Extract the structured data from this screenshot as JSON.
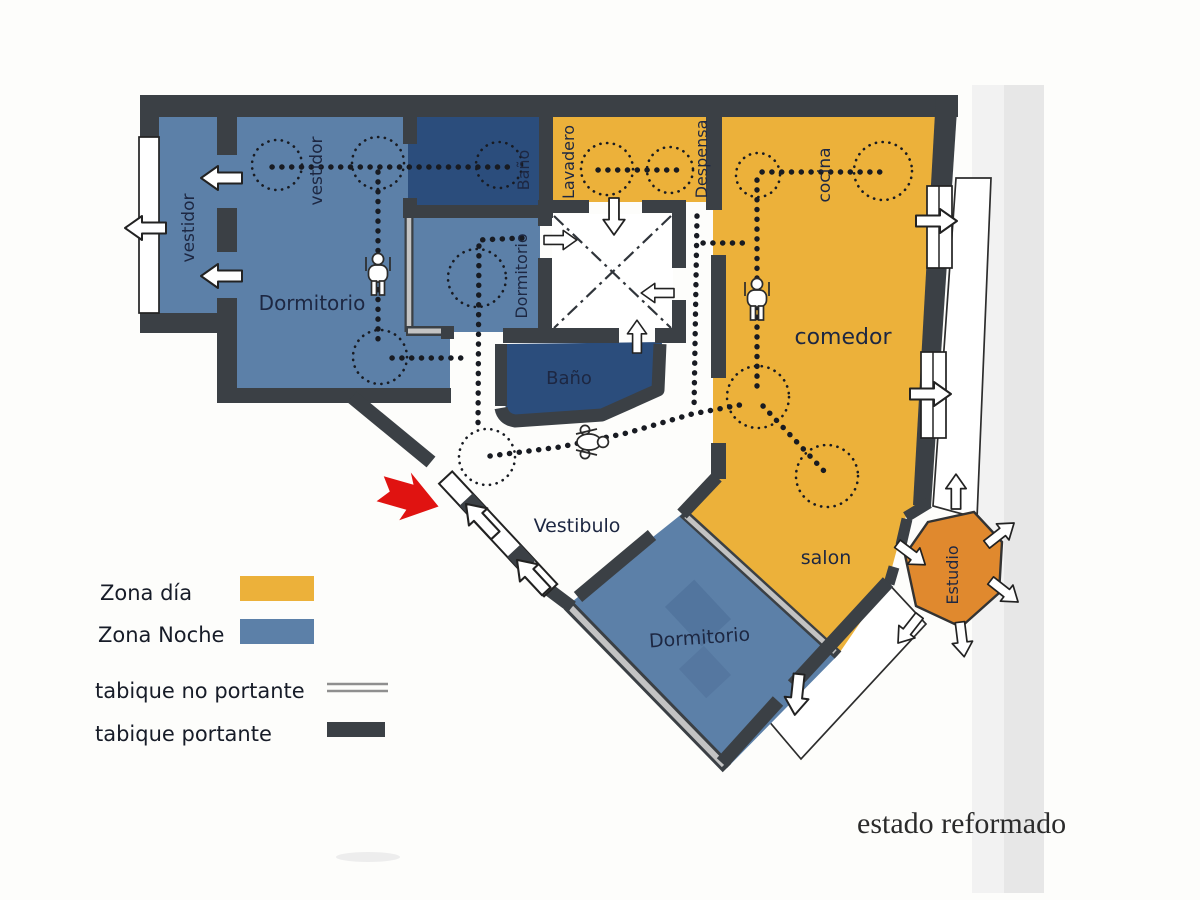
{
  "title": "estado reformado",
  "colors": {
    "day": "#ecb13a",
    "night": "#5c80a8",
    "bath": "#2b4d7c",
    "studio": "#e0892e",
    "wall": "#3b4045",
    "partition_gray": "#c3c3c3",
    "entrance_red": "#e01311",
    "label_ink": "#1d2742"
  },
  "icons": {
    "door_arrow": "white-block-arrow",
    "person": "person-figure",
    "wheelchair": "wheelchair-person-figure",
    "entrance": "red-entrance-arrow",
    "patio": "crossed-lightwell"
  },
  "rooms": [
    {
      "label": "vestidor",
      "zone": "night"
    },
    {
      "label": "vestidor",
      "zone": "night"
    },
    {
      "label": "Dormitorio",
      "zone": "night"
    },
    {
      "label": "Baño",
      "zone": "bath"
    },
    {
      "label": "Dormitorio",
      "zone": "night"
    },
    {
      "label": "Lavadero",
      "zone": "day"
    },
    {
      "label": "Despensa",
      "zone": "day"
    },
    {
      "label": "cocina",
      "zone": "day"
    },
    {
      "label": "comedor",
      "zone": "day"
    },
    {
      "label": "Baño",
      "zone": "bath"
    },
    {
      "label": "Vestibulo",
      "zone": "none"
    },
    {
      "label": "salon",
      "zone": "day"
    },
    {
      "label": "Dormitorio",
      "zone": "night"
    },
    {
      "label": "Estudio",
      "zone": "studio"
    }
  ],
  "legend": {
    "items": [
      {
        "label": "Zona día",
        "swatch": "day"
      },
      {
        "label": "Zona Noche",
        "swatch": "night"
      },
      {
        "label": "tabique no portante",
        "swatch": "thin-gray-line"
      },
      {
        "label": "tabique portante",
        "swatch": "thick-dark-bar"
      }
    ]
  }
}
